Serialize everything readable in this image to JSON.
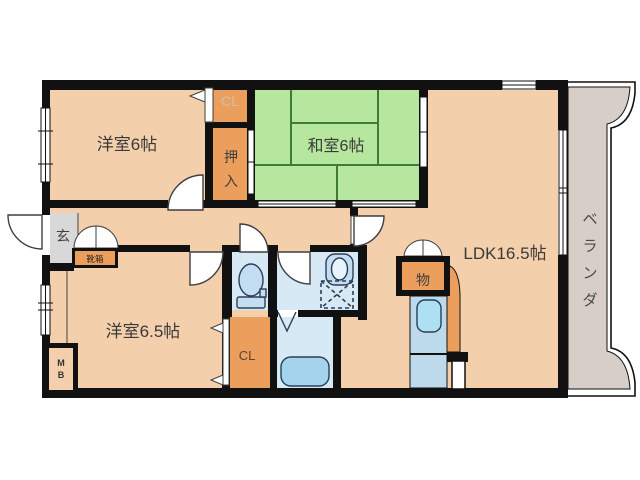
{
  "floorplan": {
    "type": "japanese-apartment-floorplan",
    "rooms": {
      "western6": {
        "label": "洋室6帖"
      },
      "japanese6": {
        "label": "和室6帖"
      },
      "ldk": {
        "label": "LDK16.5帖"
      },
      "western65": {
        "label": "洋室6.5帖"
      },
      "genkan": {
        "label": "玄"
      },
      "closet_top": {
        "label": "CL"
      },
      "closet_bottom": {
        "label": "CL"
      },
      "oshiire": {
        "label": "押入",
        "chars": [
          "押",
          "入"
        ]
      },
      "storage": {
        "label": "物"
      },
      "shoebox": {
        "label": "靴箱"
      },
      "meter_box": {
        "label": "MB",
        "chars": [
          "M",
          "B"
        ]
      },
      "veranda": {
        "label": "ベランダ",
        "chars": [
          "ベ",
          "ラ",
          "ン",
          "ダ"
        ]
      }
    },
    "colors": {
      "wall": "#111111",
      "floor": "#f3cfab",
      "tatami": "#b7e79e",
      "tatami_line": "#3e7b39",
      "closet_orange": "#ec9e5c",
      "water_floor": "#d8e9f6",
      "fixture_fill": "#c3ddf2",
      "bathtub": "#a4d3ee",
      "kitchen_counter": "#bdd9ec",
      "kitchen_sink": "#aee0f4",
      "genkan_gray": "#d8d8d8",
      "veranda_gray": "#d6cec7",
      "label_text": "#3a3a3a",
      "label_light": "#cfc0aa"
    }
  }
}
